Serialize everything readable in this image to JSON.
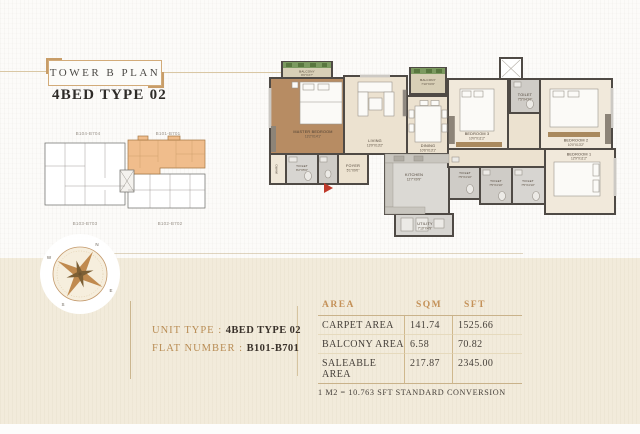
{
  "page": {
    "title": "TOWER B PLAN",
    "subtitle": "4BED TYPE 02"
  },
  "key_plan": {
    "units": [
      {
        "label": "B104-B704",
        "highlighted": false
      },
      {
        "label": "B101-B701",
        "highlighted": true
      },
      {
        "label": "B103-B703",
        "highlighted": false
      },
      {
        "label": "B102-B702",
        "highlighted": false
      }
    ],
    "highlight_color": "#f0bd8c"
  },
  "floor_plan": {
    "rooms": [
      {
        "name": "MASTER BEDROOM",
        "dims": "13'2\"X14'1\""
      },
      {
        "name": "LIVING",
        "dims": "13'9\"X13'2\""
      },
      {
        "name": "DINING",
        "dims": "10'6\"X13'1\""
      },
      {
        "name": "KITCHEN",
        "dims": "12'7\"X9'9\""
      },
      {
        "name": "UTILITY",
        "dims": "7'10\"X4'9\""
      },
      {
        "name": "FOYER",
        "dims": "5'1\"X9'0\""
      },
      {
        "name": "BEDROOM 3",
        "dims": "10'0\"X11'2\""
      },
      {
        "name": "TOILET",
        "dims": "7'5\"X4'10\""
      },
      {
        "name": "BEDROOM 2",
        "dims": "10'0\"X13'2\""
      },
      {
        "name": "BEDROOM 1",
        "dims": "12'9\"X11'2\""
      },
      {
        "name": "BALCONY",
        "dims": "9'6\"X4'7\""
      },
      {
        "name": "BALCONY",
        "dims": "7'10\"X4'9\""
      },
      {
        "name": "TOILET",
        "dims": "8'2\"X5'0\""
      },
      {
        "name": "TOILET",
        "dims": "7'5\"X4'10\""
      },
      {
        "name": "TOILET",
        "dims": "7'5\"X4'10\""
      },
      {
        "name": "TOILET",
        "dims": "7'5\"X4'10\""
      },
      {
        "name": "WARD",
        "dims": ""
      }
    ],
    "entry_marker_color": "#bf3a2b"
  },
  "compass": {
    "directions": [
      "N",
      "E",
      "S",
      "W"
    ]
  },
  "unit_info": {
    "unit_type_label": "UNIT TYPE : ",
    "unit_type_value": "4BED TYPE 02",
    "flat_number_label": "FLAT NUMBER : ",
    "flat_number_value": "B101-B701"
  },
  "area_table": {
    "headers": [
      "AREA",
      "SQM",
      "SFT"
    ],
    "rows": [
      {
        "area": "CARPET AREA",
        "sqm": "141.74",
        "sft": "1525.66"
      },
      {
        "area": "BALCONY AREA",
        "sqm": "6.58",
        "sft": "70.82"
      },
      {
        "area": "SALEABLE AREA",
        "sqm": "217.87",
        "sft": "2345.00"
      }
    ],
    "footnote": "1 M2 = 10.763 SFT STANDARD CONVERSION"
  },
  "colors": {
    "accent": "#c49a6c",
    "band": "#f2ebdb",
    "highlight": "#f0bd8c",
    "wall": "#4f4a45",
    "wood_floor": "#b78c63",
    "text_dark": "#3a322b"
  }
}
